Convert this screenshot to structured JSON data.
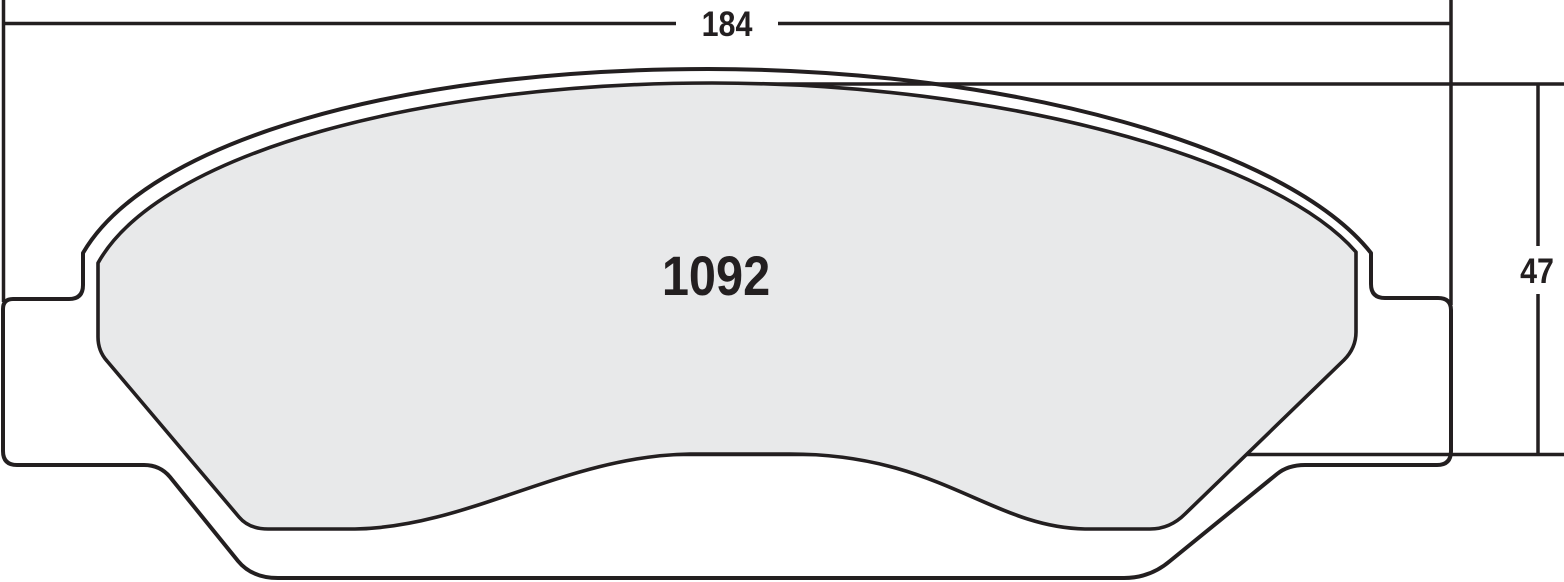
{
  "drawing": {
    "part_number": "1092",
    "dimensions": {
      "width_label": "184",
      "height_label": "47"
    }
  },
  "colors": {
    "line": "#231f20",
    "pad-fill": "#e8e9ea",
    "background": "#ffffff"
  }
}
